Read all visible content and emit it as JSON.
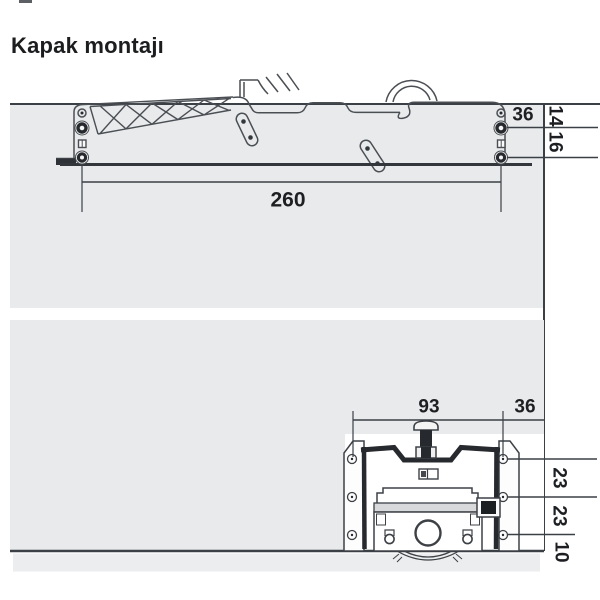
{
  "title": "Kapak montajı",
  "colors": {
    "background": "#ffffff",
    "panel_gray": "#e8eaeb",
    "panel_strip_gray": "#ecedee",
    "dark_line": "#3b4046",
    "outline": "#4b4f54",
    "dark_fill": "#26292d",
    "text": "#1d1f22"
  },
  "side_view": {
    "description": "lift mechanism side view on cabinet panel",
    "dim_width": "260",
    "dim_front": "36",
    "dim_top": "14",
    "dim_mid": "16"
  },
  "front_view": {
    "description": "drive unit front view on cabinet panel",
    "dim_span": "93",
    "dim_front": "36",
    "dim_upper": "23",
    "dim_lower": "23",
    "dim_bottom": "10"
  }
}
